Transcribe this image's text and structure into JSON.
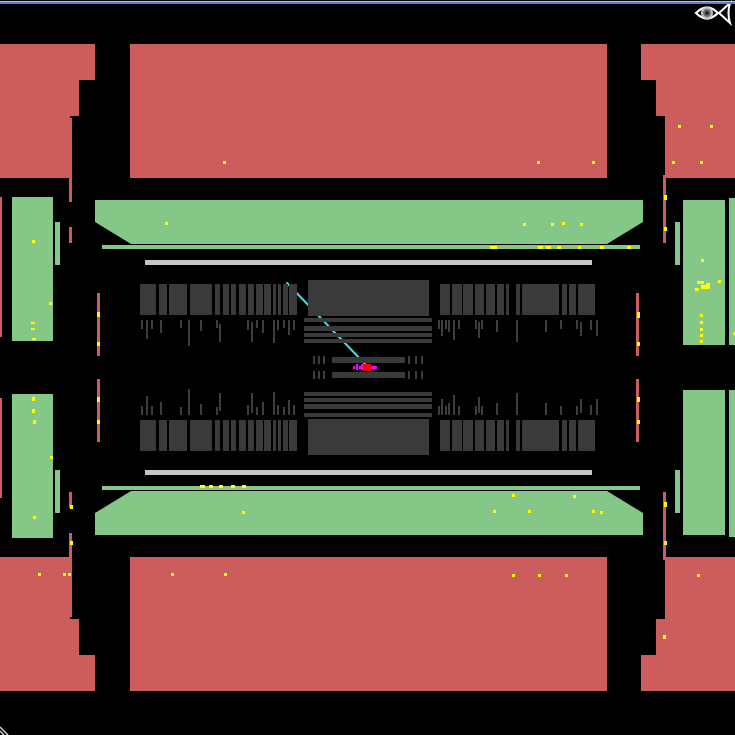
{
  "palette": {
    "background": "#000000",
    "red": "#cd5c5c",
    "green": "#85c786",
    "slab": "#3a3a3a",
    "lightbar": "#c6c6c6",
    "tick": "#3d3d3d",
    "hit": "#ffff00",
    "track": "#45dede",
    "vertex": "#ff0000",
    "vertex_marks": "#ff00ff",
    "border_light": "#a9c0ea",
    "border_blue": "#5b7fd0",
    "logo_outline": "#ffffff"
  },
  "canvas": {
    "width": 735,
    "height": 735,
    "mirror_axis": 367.5
  },
  "rects": [
    {
      "name": "window-border-top-light",
      "x": 0,
      "y": 1,
      "w": 735,
      "h": 1,
      "c": "border_light",
      "m": false
    },
    {
      "name": "window-border-top-blue",
      "x": 0,
      "y": 2,
      "w": 735,
      "h": 2,
      "c": "border_blue",
      "m": false
    },
    {
      "name": "endcap-red-top-left-outer",
      "x": 0,
      "y": 44,
      "w": 95,
      "h": 36,
      "c": "red",
      "m": true
    },
    {
      "name": "endcap-red-top-left-mid",
      "x": 0,
      "y": 80,
      "w": 79,
      "h": 36,
      "c": "red",
      "m": true
    },
    {
      "name": "endcap-red-top-left-inner",
      "x": 0,
      "y": 116,
      "w": 70,
      "h": 62,
      "c": "red",
      "m": true
    },
    {
      "name": "barrel-red-top-middle",
      "x": 130,
      "y": 44,
      "w": 477,
      "h": 134,
      "c": "red",
      "m": true
    },
    {
      "name": "endcap-red-top-right-outer",
      "x": 641,
      "y": 44,
      "w": 94,
      "h": 36,
      "c": "red",
      "m": true
    },
    {
      "name": "endcap-red-top-right-mid",
      "x": 656,
      "y": 80,
      "w": 79,
      "h": 36,
      "c": "red",
      "m": true
    },
    {
      "name": "endcap-red-top-right-inner",
      "x": 665,
      "y": 116,
      "w": 70,
      "h": 62,
      "c": "red",
      "m": true
    },
    {
      "name": "red-strip-left-a",
      "x": 69,
      "y": 118,
      "w": 3,
      "h": 84,
      "c": "red",
      "m": true
    },
    {
      "name": "red-strip-left-b",
      "x": 69,
      "y": 227,
      "w": 3,
      "h": 16,
      "c": "red",
      "m": true
    },
    {
      "name": "red-strip-left-edge-top",
      "x": 0,
      "y": 197,
      "w": 2,
      "h": 140,
      "c": "red",
      "m": false
    },
    {
      "name": "red-strip-left-edge-bottom",
      "x": 0,
      "y": 398,
      "w": 2,
      "h": 100,
      "c": "red",
      "m": false
    },
    {
      "name": "red-strip-inner-left",
      "x": 97,
      "y": 293,
      "w": 3,
      "h": 63,
      "c": "red",
      "m": true
    },
    {
      "name": "red-strip-inner-right",
      "x": 636,
      "y": 293,
      "w": 3,
      "h": 63,
      "c": "red",
      "m": true
    },
    {
      "name": "red-strip-right",
      "x": 663,
      "y": 175,
      "w": 3,
      "h": 68,
      "c": "red",
      "m": true
    },
    {
      "name": "muon-green-tall-left",
      "x": 12,
      "y": 197,
      "w": 41,
      "h": 144,
      "c": "green",
      "m": true
    },
    {
      "name": "muon-green-small-left",
      "x": 55,
      "y": 222,
      "w": 5,
      "h": 43,
      "c": "green",
      "m": true
    },
    {
      "name": "muon-green-tall-right",
      "x": 683,
      "y": 200,
      "w": 42,
      "h": 145,
      "c": "green",
      "m": true
    },
    {
      "name": "muon-green-small-right",
      "x": 675,
      "y": 222,
      "w": 5,
      "h": 43,
      "c": "green",
      "m": true
    },
    {
      "name": "muon-green-sliver-right",
      "x": 729,
      "y": 198,
      "w": 6,
      "h": 147,
      "c": "green",
      "m": true
    },
    {
      "name": "muon-green-bar-top",
      "x": 95,
      "y": 200,
      "w": 548,
      "h": 44,
      "c": "green",
      "m": false,
      "clip": "0 0,548 0,548 22,512 44,36 44,0 22"
    },
    {
      "name": "muon-green-bar-bottom",
      "x": 95,
      "y": 491,
      "w": 548,
      "h": 44,
      "c": "green",
      "m": false,
      "clip": "0 22,36 0,512 0,548 22,548 44,0 44"
    },
    {
      "name": "green-line-top",
      "x": 102,
      "y": 245,
      "w": 538,
      "h": 4,
      "c": "green",
      "m": true
    },
    {
      "name": "support-bar-white",
      "x": 145,
      "y": 260,
      "w": 447,
      "h": 5,
      "c": "lightbar",
      "m": true
    },
    {
      "name": "calo-central-block",
      "x": 308,
      "y": 280,
      "w": 121,
      "h": 36,
      "c": "slab",
      "m": true
    },
    {
      "name": "inner-detector-bar",
      "x": 332,
      "y": 357,
      "w": 73,
      "h": 6,
      "c": "slab",
      "m": true
    }
  ],
  "slab_rows": {
    "y": 284,
    "h": 31,
    "left": [
      [
        140,
        16
      ],
      [
        159,
        8
      ],
      [
        169,
        18
      ],
      [
        190,
        22
      ],
      [
        215,
        5
      ],
      [
        223,
        6
      ],
      [
        231,
        5
      ],
      [
        239,
        7
      ],
      [
        248,
        6
      ],
      [
        256,
        7
      ],
      [
        264,
        7
      ],
      [
        273,
        3
      ],
      [
        278,
        3
      ],
      [
        283,
        5
      ],
      [
        289,
        8
      ]
    ],
    "right": [
      [
        440,
        10
      ],
      [
        452,
        10
      ],
      [
        463,
        10
      ],
      [
        475,
        9
      ],
      [
        486,
        9
      ],
      [
        497,
        7
      ],
      [
        506,
        3
      ],
      [
        516,
        4
      ],
      [
        522,
        37
      ],
      [
        562,
        5
      ],
      [
        569,
        7
      ],
      [
        578,
        17
      ]
    ]
  },
  "strips": {
    "x": 304,
    "w": 128,
    "bars": [
      [
        318,
        4
      ],
      [
        326,
        5
      ],
      [
        333,
        4
      ],
      [
        339,
        4
      ]
    ]
  },
  "ticks": [
    [
      141,
      320,
      9
    ],
    [
      146,
      320,
      19
    ],
    [
      151,
      320,
      9
    ],
    [
      160,
      320,
      13
    ],
    [
      180,
      320,
      8
    ],
    [
      188,
      320,
      26
    ],
    [
      200,
      320,
      11
    ],
    [
      216,
      320,
      8
    ],
    [
      219,
      324,
      18
    ],
    [
      247,
      320,
      10
    ],
    [
      251,
      322,
      20
    ],
    [
      256,
      320,
      8
    ],
    [
      262,
      320,
      13
    ],
    [
      273,
      320,
      23
    ],
    [
      277,
      320,
      10
    ],
    [
      283,
      320,
      8
    ],
    [
      288,
      320,
      15
    ],
    [
      293,
      320,
      10
    ],
    [
      438,
      320,
      9
    ],
    [
      441,
      320,
      16
    ],
    [
      445,
      320,
      9
    ],
    [
      448,
      320,
      12
    ],
    [
      453,
      320,
      20
    ],
    [
      458,
      320,
      9
    ],
    [
      475,
      320,
      9
    ],
    [
      478,
      322,
      16
    ],
    [
      481,
      320,
      9
    ],
    [
      496,
      320,
      12
    ],
    [
      516,
      320,
      22
    ],
    [
      545,
      320,
      12
    ],
    [
      560,
      320,
      9
    ],
    [
      576,
      320,
      9
    ],
    [
      580,
      322,
      14
    ],
    [
      590,
      320,
      10
    ],
    [
      596,
      320,
      16
    ],
    [
      313,
      356,
      8
    ],
    [
      318,
      356,
      8
    ],
    [
      323,
      356,
      8
    ],
    [
      408,
      356,
      8
    ],
    [
      415,
      356,
      8
    ],
    [
      421,
      356,
      8
    ]
  ],
  "hits": [
    [
      223,
      161,
      3,
      3
    ],
    [
      537,
      161,
      3,
      3
    ],
    [
      592,
      161,
      3,
      3
    ],
    [
      672,
      161,
      3,
      3
    ],
    [
      700,
      161,
      3,
      3
    ],
    [
      678,
      125,
      3,
      3
    ],
    [
      710,
      125,
      3,
      3
    ],
    [
      165,
      222,
      3,
      3
    ],
    [
      523,
      223,
      3,
      3
    ],
    [
      551,
      223,
      3,
      3
    ],
    [
      562,
      222,
      3,
      3
    ],
    [
      580,
      223,
      3,
      3
    ],
    [
      490,
      246,
      7,
      3
    ],
    [
      538,
      246,
      5,
      3
    ],
    [
      546,
      246,
      5,
      3
    ],
    [
      557,
      246,
      4,
      3
    ],
    [
      578,
      246,
      3,
      3
    ],
    [
      600,
      246,
      4,
      3
    ],
    [
      627,
      246,
      4,
      3
    ],
    [
      32,
      240,
      3,
      3
    ],
    [
      49,
      302,
      3,
      3
    ],
    [
      31,
      322,
      4,
      2
    ],
    [
      31,
      328,
      4,
      2
    ],
    [
      32,
      338,
      4,
      2
    ],
    [
      97,
      312,
      3,
      5
    ],
    [
      97,
      342,
      3,
      4
    ],
    [
      637,
      312,
      3,
      6
    ],
    [
      637,
      342,
      3,
      4
    ],
    [
      664,
      195,
      3,
      5
    ],
    [
      664,
      227,
      3,
      4
    ],
    [
      701,
      259,
      3,
      3
    ],
    [
      718,
      280,
      3,
      3
    ],
    [
      733,
      332,
      2,
      3
    ],
    [
      697,
      281,
      7,
      3
    ],
    [
      701,
      285,
      9,
      4
    ],
    [
      695,
      288,
      4,
      3
    ],
    [
      706,
      283,
      4,
      2
    ],
    [
      700,
      314,
      3,
      3
    ],
    [
      700,
      321,
      3,
      3
    ],
    [
      700,
      328,
      3,
      3
    ],
    [
      700,
      334,
      3,
      3
    ],
    [
      700,
      340,
      3,
      3
    ],
    [
      200,
      485,
      5,
      3
    ],
    [
      209,
      485,
      4,
      3
    ],
    [
      219,
      485,
      4,
      3
    ],
    [
      231,
      485,
      4,
      3
    ],
    [
      242,
      485,
      4,
      3
    ],
    [
      512,
      494,
      3,
      3
    ],
    [
      573,
      495,
      3,
      3
    ],
    [
      493,
      510,
      3,
      3
    ],
    [
      528,
      510,
      3,
      3
    ],
    [
      592,
      510,
      3,
      3
    ],
    [
      600,
      511,
      3,
      3
    ],
    [
      242,
      511,
      3,
      3
    ],
    [
      32,
      397,
      3,
      4
    ],
    [
      32,
      409,
      3,
      4
    ],
    [
      33,
      420,
      3,
      4
    ],
    [
      33,
      516,
      3,
      3
    ],
    [
      50,
      456,
      3,
      3
    ],
    [
      97,
      397,
      3,
      5
    ],
    [
      97,
      420,
      3,
      4
    ],
    [
      637,
      397,
      3,
      5
    ],
    [
      637,
      420,
      3,
      4
    ],
    [
      70,
      505,
      3,
      4
    ],
    [
      70,
      541,
      3,
      4
    ],
    [
      664,
      502,
      3,
      5
    ],
    [
      664,
      541,
      3,
      4
    ],
    [
      663,
      635,
      3,
      4
    ],
    [
      38,
      573,
      3,
      3
    ],
    [
      63,
      573,
      3,
      3
    ],
    [
      68,
      573,
      3,
      3
    ],
    [
      171,
      573,
      3,
      3
    ],
    [
      224,
      573,
      3,
      3
    ],
    [
      512,
      574,
      3,
      3
    ],
    [
      538,
      574,
      3,
      3
    ],
    [
      565,
      574,
      3,
      3
    ],
    [
      697,
      574,
      3,
      3
    ]
  ],
  "vertex": {
    "x": 363,
    "y": 364,
    "w": 8,
    "h": 7,
    "marks": [
      [
        353,
        366,
        2,
        3
      ],
      [
        356,
        364,
        2,
        6
      ],
      [
        359,
        366,
        2,
        3
      ],
      [
        361,
        364,
        2,
        6
      ],
      [
        371,
        366,
        6,
        3
      ]
    ]
  },
  "track": {
    "x1": 287,
    "y1": 283,
    "x2": 366,
    "y2": 365
  }
}
